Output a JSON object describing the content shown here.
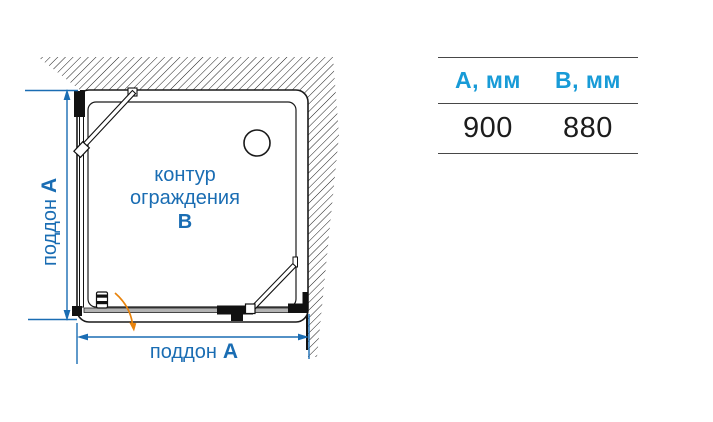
{
  "diagram": {
    "side_dimension_label": {
      "text": "поддон",
      "dim": "A"
    },
    "bottom_dimension_label": {
      "text": "поддон",
      "dim": "A"
    },
    "contour_label": {
      "line1": "контур",
      "line2": "ограждения",
      "dim": "B"
    },
    "colors": {
      "dimension_blue": "#1a6db3",
      "door_swing_orange": "#e8830c",
      "table_header_blue": "#189bd7"
    }
  },
  "table": {
    "columns": [
      {
        "header": "A, мм",
        "value": "900"
      },
      {
        "header": "B, мм",
        "value": "880"
      }
    ]
  }
}
